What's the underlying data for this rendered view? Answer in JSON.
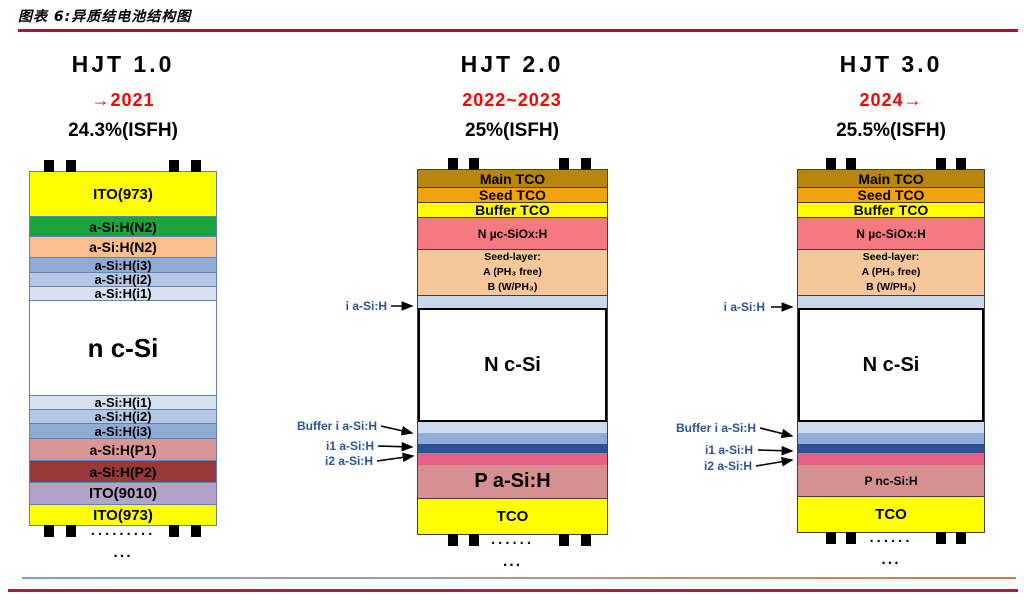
{
  "header": {
    "title": "图表 6:异质结电池结构图"
  },
  "accents": {
    "year_red": "#FE0000",
    "title_rule_red": "#C00334",
    "bottom_rule_red": "#A81E3C",
    "annotation_blue": "#2B5597",
    "stack1_border": "#5E83B4",
    "stack23_border": "#404040"
  },
  "columns": [
    {
      "title": "HJT 1.0",
      "period": "→2021",
      "efficiency": "24.3%(ISFH)",
      "border_color": "#5E83B4",
      "sep_color": "#5E83B4",
      "dots": ".........",
      "ellipsis": "...",
      "side_labels": [],
      "layers": [
        {
          "label": "ITO(973)",
          "color": "#FFFF00",
          "h": 44,
          "fs": 15
        },
        {
          "label": "a-Si:H(N2)",
          "color": "#1CA53C",
          "h": 20,
          "fs": 14,
          "sep": true
        },
        {
          "label": "a-Si:H(N2)",
          "color": "#F8BE8E",
          "h": 21,
          "fs": 14,
          "sep": true
        },
        {
          "label": "a-Si:H(i3)",
          "color": "#8FABD3",
          "h": 15,
          "fs": 13,
          "sep": true
        },
        {
          "label": "a-Si:H(i2)",
          "color": "#B5C7E3",
          "h": 14,
          "fs": 13,
          "sep": true
        },
        {
          "label": "a-Si:H(i1)",
          "color": "#D7E1F0",
          "h": 14,
          "fs": 13,
          "sep": true
        },
        {
          "label": "n c-Si",
          "color": "#FFFFFF",
          "h": 95,
          "fs": 26,
          "sep": true
        },
        {
          "label": "a-Si:H(i1)",
          "color": "#D7E1F0",
          "h": 14,
          "fs": 13,
          "sep": true
        },
        {
          "label": "a-Si:H(i2)",
          "color": "#B5C7E3",
          "h": 14,
          "fs": 13,
          "sep": true
        },
        {
          "label": "a-Si:H(i3)",
          "color": "#8FABD3",
          "h": 15,
          "fs": 13,
          "sep": true
        },
        {
          "label": "a-Si:H(P1)",
          "color": "#DA9694",
          "h": 22,
          "fs": 14,
          "sep": true
        },
        {
          "label": "a-Si:H(P2)",
          "color": "#97383A",
          "h": 22,
          "fs": 14,
          "sep": true
        },
        {
          "label": "ITO(9010)",
          "color": "#B3A2C9",
          "h": 22,
          "fs": 15,
          "sep": true
        },
        {
          "label": "ITO(973)",
          "color": "#FFFF00",
          "h": 21,
          "fs": 15,
          "sep": true
        }
      ]
    },
    {
      "title": "HJT 2.0",
      "period": "2022~2023",
      "efficiency": "25%(ISFH)",
      "border_color": "#404040",
      "sep_color": "#404040",
      "dots": "......",
      "ellipsis": "...",
      "side_labels": [
        "i a-Si:H",
        "Buffer i a-Si:H",
        "i1 a-Si:H",
        "i2 a-Si:H"
      ],
      "layers": [
        {
          "label": "Main TCO",
          "color": "#B8860B",
          "h": 17,
          "fs": 14
        },
        {
          "label": "Seed TCO",
          "color": "#F0A30C",
          "h": 15,
          "fs": 14,
          "sep": true
        },
        {
          "label": "Buffer TCO",
          "color": "#FFFF00",
          "h": 15,
          "fs": 14,
          "sep": true
        },
        {
          "label": "N µc-SiOx:H",
          "color": "#F47A7F",
          "h": 32,
          "fs": 12,
          "sep": true
        },
        {
          "lines": [
            "Seed-layer:",
            "A (PH₃ free)",
            "B (W/PH₃)"
          ],
          "color": "#F6C79B",
          "h": 46,
          "fs": 10.5,
          "sep": true
        },
        {
          "label": "",
          "color": "#CAD8EC",
          "h": 13,
          "sep": true
        },
        {
          "label": "N c-Si",
          "color": "#FFFFFF",
          "h": 114,
          "fs": 20,
          "framed": true
        },
        {
          "label": "",
          "color": "#CEDBEE",
          "h": 11
        },
        {
          "label": "",
          "color": "#90ADD9",
          "h": 11
        },
        {
          "label": "",
          "color": "#2F5096",
          "h": 9
        },
        {
          "label": "",
          "color": "#E85F88",
          "h": 12
        },
        {
          "label": "P a-Si:H",
          "color": "#D69091",
          "h": 33,
          "fs": 20
        },
        {
          "label": "TCO",
          "color": "#FFFF00",
          "h": 36,
          "fs": 15,
          "sep": true
        }
      ]
    },
    {
      "title": "HJT 3.0",
      "period": "2024→",
      "efficiency": "25.5%(ISFH)",
      "border_color": "#404040",
      "sep_color": "#404040",
      "dots": "......",
      "ellipsis": "...",
      "side_labels": [
        "i a-Si:H",
        "Buffer i a-Si:H",
        "i1 a-Si:H",
        "i2 a-Si:H"
      ],
      "layers": [
        {
          "label": "Main TCO",
          "color": "#B8860B",
          "h": 17,
          "fs": 14
        },
        {
          "label": "Seed TCO",
          "color": "#F0A30C",
          "h": 15,
          "fs": 14,
          "sep": true
        },
        {
          "label": "Buffer TCO",
          "color": "#FFFF00",
          "h": 15,
          "fs": 14,
          "sep": true
        },
        {
          "label": "N µc-SiOx:H",
          "color": "#F47A7F",
          "h": 32,
          "fs": 12,
          "sep": true
        },
        {
          "lines": [
            "Seed-layer:",
            "A (PH₃ free)",
            "B (W/PH₃)"
          ],
          "color": "#F6C79B",
          "h": 46,
          "fs": 10.5,
          "sep": true
        },
        {
          "label": "",
          "color": "#CAD8EC",
          "h": 13,
          "sep": true
        },
        {
          "label": "N c-Si",
          "color": "#FFFFFF",
          "h": 114,
          "fs": 20,
          "framed": true
        },
        {
          "label": "",
          "color": "#CEDBEE",
          "h": 11
        },
        {
          "label": "",
          "color": "#90ADD9",
          "h": 11
        },
        {
          "label": "",
          "color": "#2F5096",
          "h": 9
        },
        {
          "label": "",
          "color": "#E85F88",
          "h": 12
        },
        {
          "label": "P nc-Si:H",
          "color": "#D69091",
          "h": 31,
          "fs": 12
        },
        {
          "label": "TCO",
          "color": "#FFFF00",
          "h": 36,
          "fs": 15,
          "sep": true
        }
      ]
    }
  ]
}
